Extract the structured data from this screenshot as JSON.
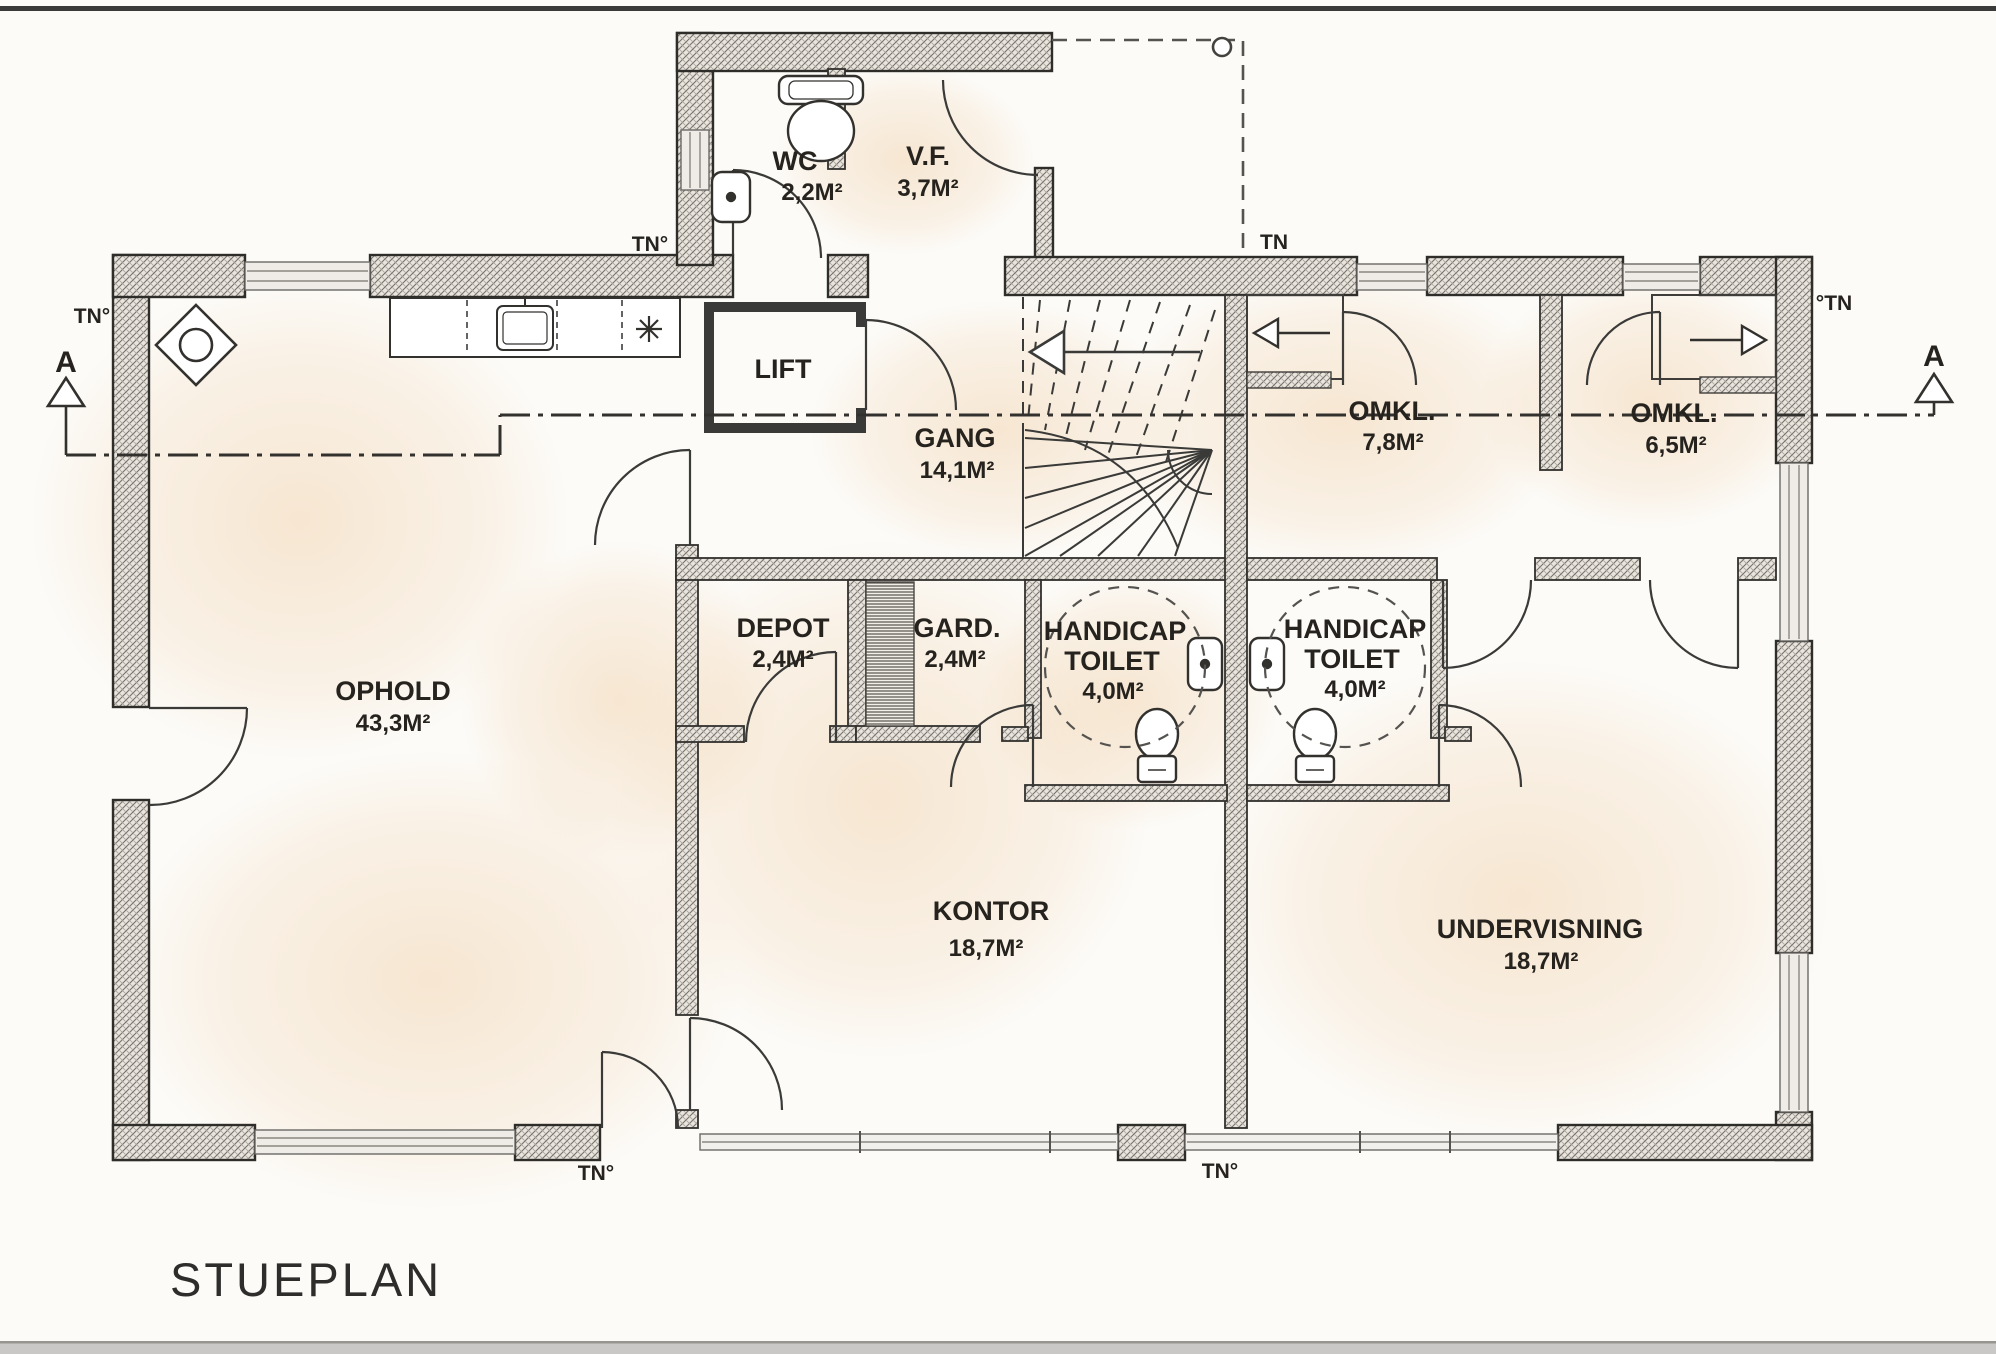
{
  "title": "STUEPLAN",
  "rooms": {
    "wc": {
      "name": "WC",
      "area": "2,2M²"
    },
    "vf": {
      "name": "V.F.",
      "area": "3,7M²"
    },
    "lift": {
      "name": "LIFT"
    },
    "gang": {
      "name": "GANG",
      "area": "14,1M²"
    },
    "omkl1": {
      "name": "OMKL.",
      "area": "7,8M²"
    },
    "omkl2": {
      "name": "OMKL.",
      "area": "6,5M²"
    },
    "ophold": {
      "name": "OPHOLD",
      "area": "43,3M²"
    },
    "depot": {
      "name": "DEPOT",
      "area": "2,4M²"
    },
    "gard": {
      "name": "GARD.",
      "area": "2,4M²"
    },
    "handicap_toilet_left": {
      "name": "HANDICAP",
      "name2": "TOILET",
      "area": "4,0M²"
    },
    "handicap_toilet_right": {
      "name": "HANDICAP",
      "name2": "TOILET",
      "area": "4,0M²"
    },
    "kontor": {
      "name": "KONTOR",
      "area": "18,7M²"
    },
    "undervisning": {
      "name": "UNDERVISNING",
      "area": "18,7M²"
    }
  },
  "markers": {
    "tn_top_left": "TN°",
    "tn_kitchen": "TN°",
    "tn_porch": "TN",
    "tn_top_right": "°TN",
    "tn_bottom_left": "TN°",
    "tn_bottom_mid": "TN°",
    "section_left": "A",
    "section_right": "A"
  },
  "colors": {
    "line": "#2e2c29",
    "wall_fill": "#e9e5de",
    "tint": "#f2d5b2",
    "paper": "#fcfbf8"
  }
}
